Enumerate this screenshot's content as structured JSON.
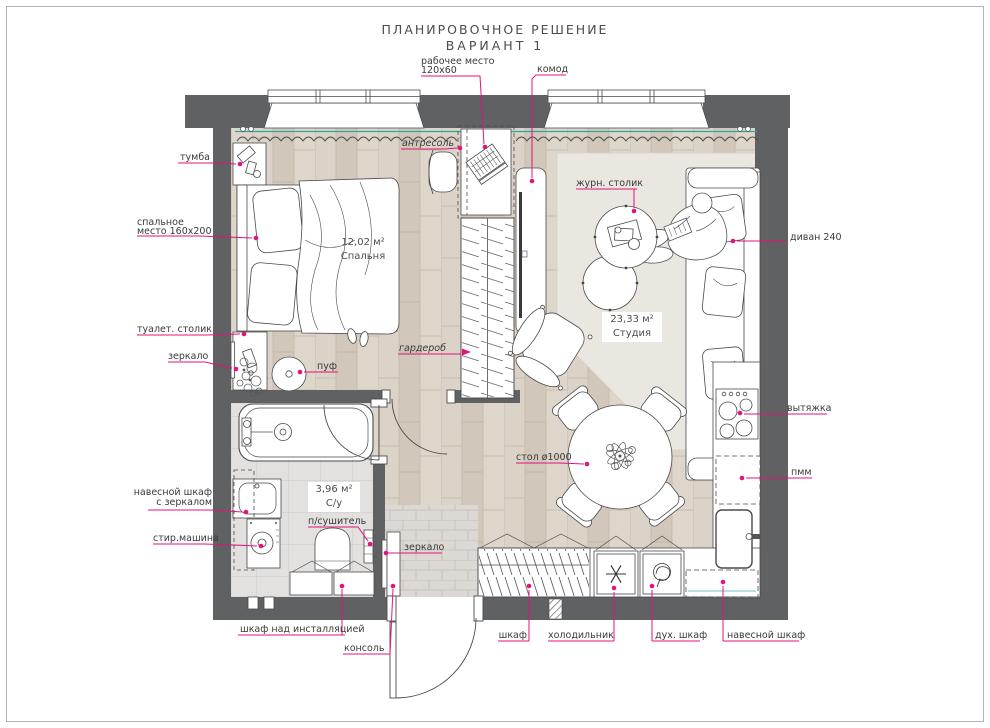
{
  "title": {
    "line1": "ПЛАНИРОВОЧНОЕ РЕШЕНИЕ",
    "line2": "ВАРИАНТ 1"
  },
  "areas": {
    "bedroom_area": "12,02 м²",
    "bedroom_name": "Спальня",
    "studio_area": "23,33 м²",
    "studio_name": "Студия",
    "bath_area": "3,96 м²",
    "bath_name": "С/у"
  },
  "labels": {
    "tumba": "тумба",
    "bed_line1": "спальное",
    "bed_line2": "место 160х200",
    "toilet_table": "туалет. столик",
    "mirror_bath": "зеркало",
    "pouf": "пуф",
    "antresol": "антресоль",
    "wardrobe": "гардероб",
    "workplace_line1": "рабочее место",
    "workplace_line2": "120х60",
    "komod": "комод",
    "coffee_table": "журн. столик",
    "sofa": "диван 240",
    "hood": "вытяжка",
    "dishwasher": "пмм",
    "table": "стол ø1000",
    "wall_cabinet_mirror_line1": "навесной шкаф",
    "wall_cabinet_mirror_line2": "с зеркалом",
    "washing_machine": "стир.машина",
    "towel_dryer": "п/сушитель",
    "cabinet_installation": "шкаф над инсталляцией",
    "console": "консоль",
    "mirror_hall": "зеркало",
    "closet": "шкаф",
    "fridge": "холодильник",
    "oven": "дух. шкаф",
    "wall_cabinet_kitchen": "навесной шкаф"
  },
  "colors": {
    "wall": "#5f6163",
    "leader": "#e4127e",
    "curtain_rod": "#2aa7a0",
    "wood": "#d7cec2",
    "tile": "#e2e1df",
    "text": "#3a3a3a"
  }
}
